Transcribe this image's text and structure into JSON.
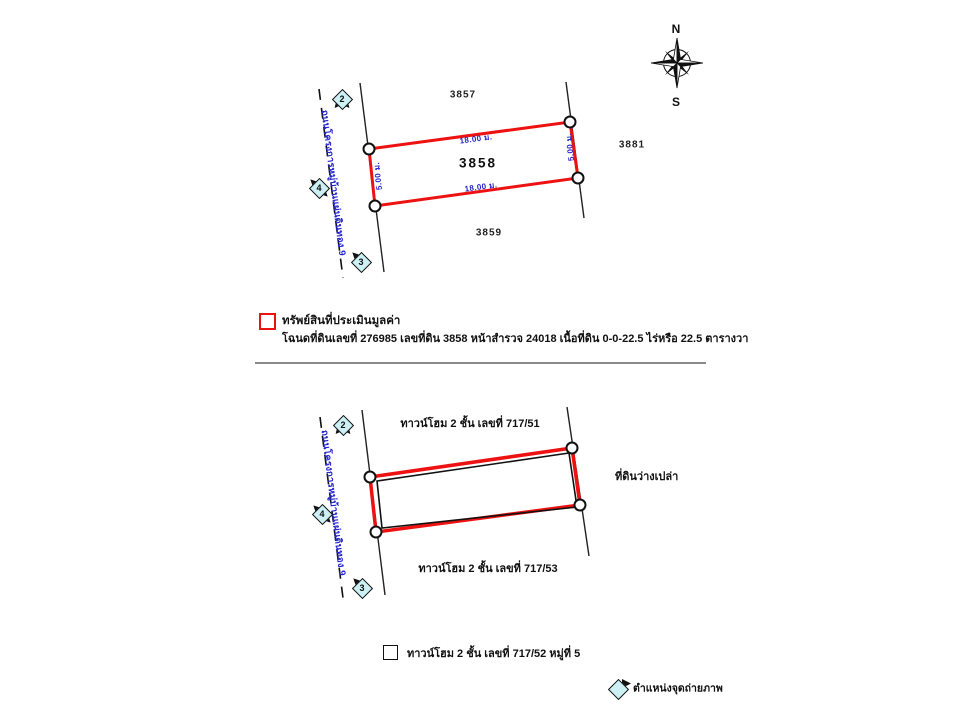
{
  "compass": {
    "north": "N",
    "south": "S"
  },
  "colors": {
    "plot_boundary_red": "#ee1111",
    "building_outline_black": "#111111",
    "dimension_blue": "#2424cc",
    "road_text_blue": "#2424cc",
    "marker_fill_cyan": "#ccf0f4",
    "divider_gray": "#8a8a8a"
  },
  "top_diagram": {
    "road_name": "ถนนโครงการหมู่บ้านแผ่นดินทอง 9",
    "parcel_above": "3857",
    "parcel_subject": "3858",
    "parcel_below": "3859",
    "parcel_right": "3881",
    "dim_top": "18.00 ม.",
    "dim_bottom": "18.00 ม.",
    "dim_left": "5.00 ม.",
    "dim_right": "5.00 ม.",
    "markers": [
      {
        "label": "2"
      },
      {
        "label": "4"
      },
      {
        "label": "3"
      }
    ]
  },
  "legend_property": {
    "title": "ทรัพย์สินที่ประเมินมูลค่า",
    "detail": "โฉนดที่ดินเลขที่ 276985 เลขที่ดิน 3858 หน้าสำรวจ 24018 เนื้อที่ดิน 0-0-22.5 ไร่หรือ 22.5 ตารางวา"
  },
  "bottom_diagram": {
    "road_name": "ถนนโครงการหมู่บ้านแผ่นดินทอง 9",
    "label_above": "ทาวน์โฮม 2 ชั้น เลขที่ 717/51",
    "label_below": "ทาวน์โฮม 2 ชั้น เลขที่ 717/53",
    "label_right": "ที่ดินว่างเปล่า",
    "markers": [
      {
        "label": "2"
      },
      {
        "label": "4"
      },
      {
        "label": "3"
      }
    ]
  },
  "legend_building": {
    "label": "ทาวน์โฮม 2 ชั้น เลขที่ 717/52 หมู่ที่ 5"
  },
  "legend_photo": {
    "label": "ตำแหน่งจุดถ่ายภาพ"
  }
}
